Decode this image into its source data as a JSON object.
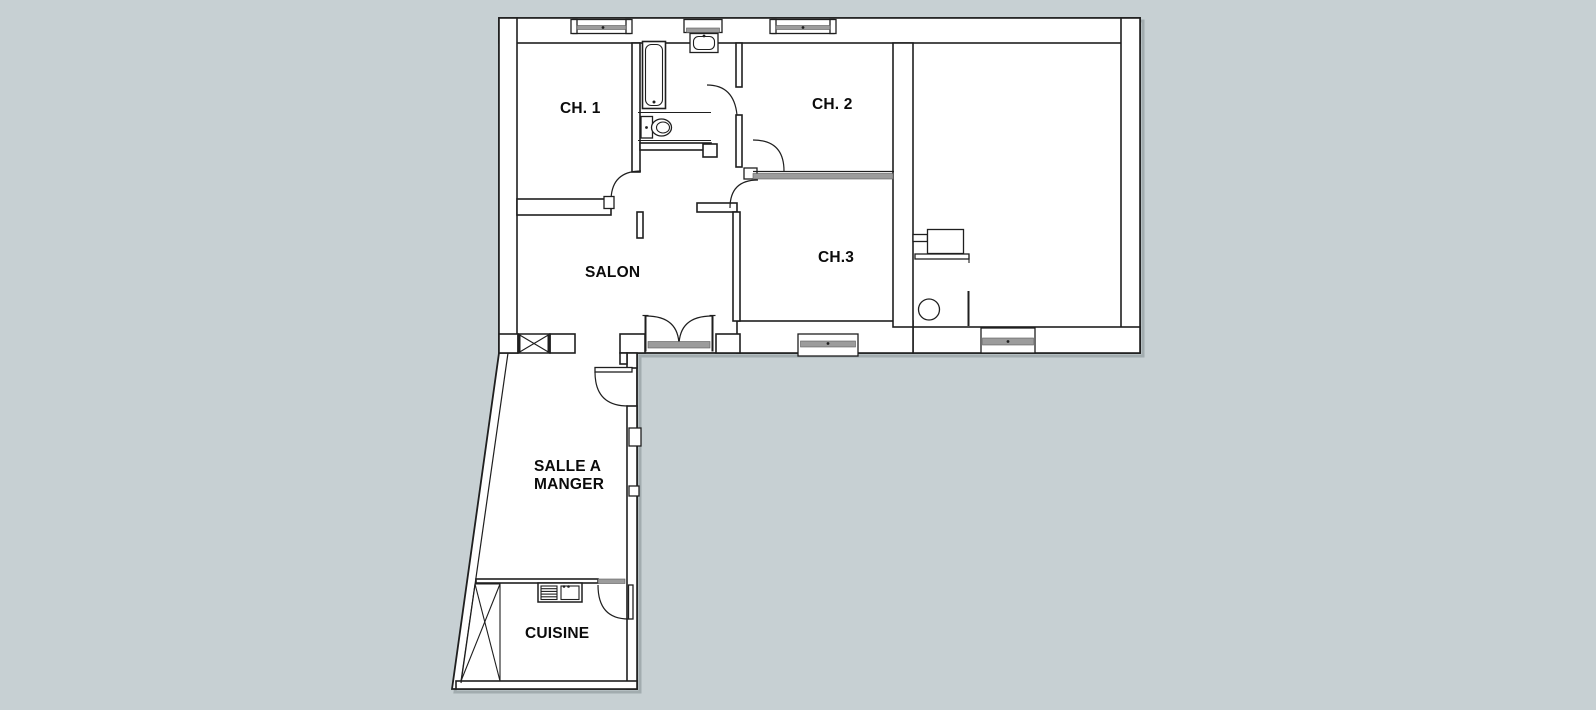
{
  "plan": {
    "title": "apartment-floor-plan",
    "rooms": [
      {
        "id": "ch1",
        "label": "CH. 1"
      },
      {
        "id": "ch2",
        "label": "CH. 2"
      },
      {
        "id": "ch3",
        "label": "CH.3"
      },
      {
        "id": "salon",
        "label": "SALON"
      },
      {
        "id": "salle-a-manger",
        "label_line1": "SALLE A",
        "label_line2": "MANGER"
      },
      {
        "id": "cuisine",
        "label": "CUISINE"
      }
    ],
    "icons": [
      "bathtub-icon",
      "washbasin-icon",
      "toilet-icon",
      "kitchen-sink-icon",
      "chimney-flue-icon",
      "hatched-closet-icon",
      "workbench-icon",
      "stool-icon",
      "window-icon",
      "door-swing-icon",
      "french-door-icon",
      "entry-door-icon"
    ],
    "colors": {
      "background": "#c7d0d3",
      "floor": "#ffffff",
      "line": "#1f1f1f",
      "fixture_gray": "#9c9c9c",
      "shadow": "#a2acaf"
    }
  }
}
